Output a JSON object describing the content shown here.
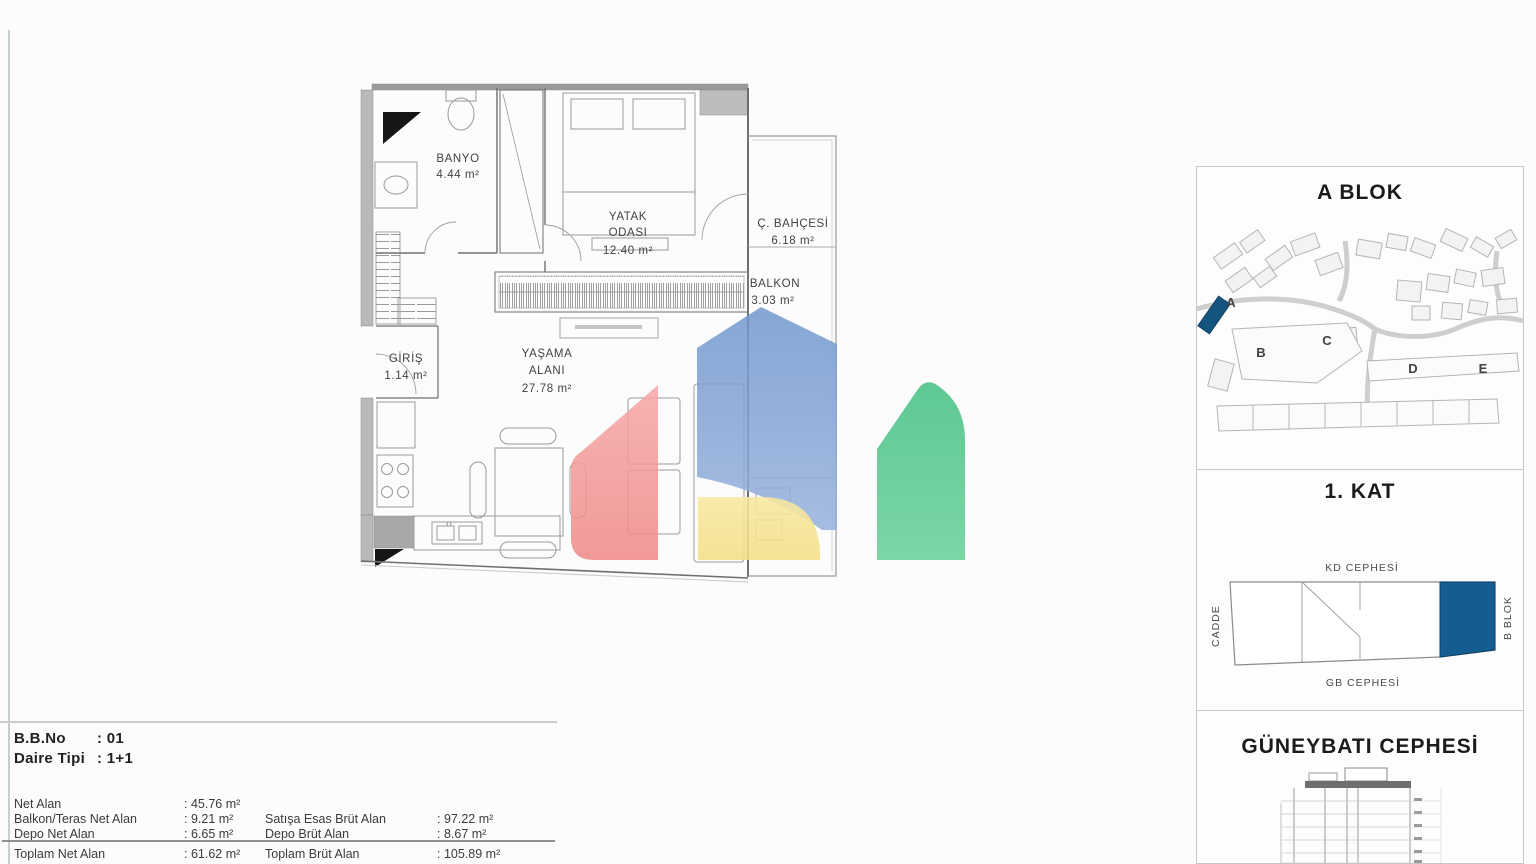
{
  "sheet": {
    "background": "#fcfcfc"
  },
  "floor_plan": {
    "rooms": {
      "banyo": {
        "name": "BANYO",
        "area": "4.44 m²"
      },
      "yatak_odasi": {
        "name_line1": "YATAK",
        "name_line2": "ODASI",
        "area": "12.40 m²"
      },
      "kis_bahcesi": {
        "name": "Ç. BAHÇESİ",
        "area": "6.18 m²"
      },
      "balkon": {
        "name": "BALKON",
        "area": "3.03 m²"
      },
      "giris": {
        "name": "GİRİŞ",
        "area": "1.14 m²"
      },
      "yasama_alani": {
        "name_line1": "YAŞAMA",
        "name_line2": "ALANI",
        "area": "27.78 m²"
      }
    }
  },
  "logo_watermark": {
    "colors": {
      "red": "#f29090",
      "blue": "#84a5d7",
      "yellow": "#f5e28c",
      "green": "#5bcb90"
    }
  },
  "sidebar": {
    "site_panel": {
      "title": "A BLOK",
      "block_letters": [
        "A",
        "B",
        "C",
        "D",
        "E"
      ],
      "highlight_color": "#14557f",
      "letter_color": "#3f6c9e"
    },
    "floor_panel": {
      "title": "1. KAT",
      "top_facade_label": "KD CEPHESİ",
      "bottom_facade_label": "GB CEPHESİ",
      "street_label": "CADDE",
      "block_label": "B BLOK",
      "highlight_color": "#155d90"
    },
    "facade_panel": {
      "title": "GÜNEYBATI CEPHESİ"
    }
  },
  "info_table": {
    "unit_no_label": "B.B.No",
    "unit_no_value": ": 01",
    "unit_type_label": "Daire Tipi",
    "unit_type_value": ": 1+1",
    "left_rows": [
      {
        "label": "Net Alan",
        "value": ": 45.76 m²"
      },
      {
        "label": "Balkon/Teras Net Alan",
        "value": ": 9.21 m²"
      },
      {
        "label": "Depo Net Alan",
        "value": ": 6.65 m²"
      },
      {
        "label": "Toplam Net Alan",
        "value": ": 61.62 m²"
      }
    ],
    "right_rows": [
      {
        "label": "Satışa Esas Brüt Alan",
        "value": ": 97.22 m²"
      },
      {
        "label": "Depo Brüt Alan",
        "value": ": 8.67 m²"
      },
      {
        "label": "Toplam Brüt Alan",
        "value": ": 105.89 m²"
      }
    ]
  }
}
